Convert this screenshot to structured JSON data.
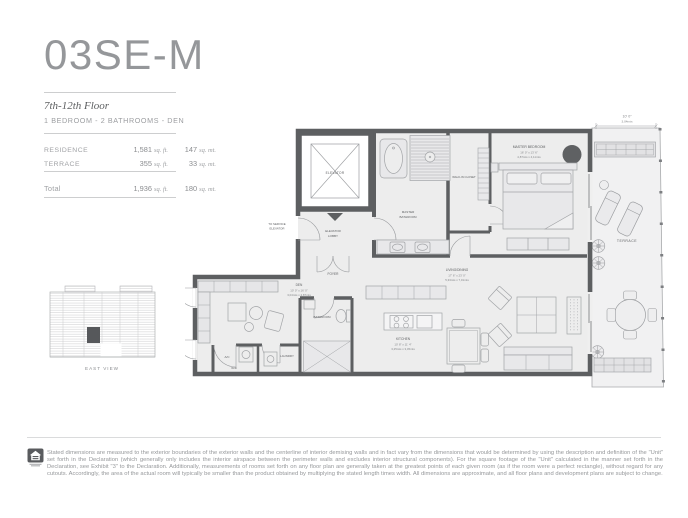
{
  "header": {
    "unit_name": "03SE-M",
    "floors": "7th-12th Floor",
    "program": "1 BEDROOM - 2 BATHROOMS - DEN"
  },
  "area_table": {
    "rows": [
      {
        "label": "RESIDENCE",
        "sqft": "1,581",
        "sqft_unit": "sq. ft.",
        "sqmt": "147",
        "sqmt_unit": "sq. mt."
      },
      {
        "label": "TERRACE",
        "sqft": "355",
        "sqft_unit": "sq. ft.",
        "sqmt": "33",
        "sqmt_unit": "sq. mt."
      }
    ],
    "total": {
      "label": "Total",
      "sqft": "1,936",
      "sqft_unit": "sq. ft.",
      "sqmt": "180",
      "sqmt_unit": "sq. mt."
    }
  },
  "keyplan": {
    "caption": "EAST VIEW"
  },
  "floorplan": {
    "elevator": "ELEVATOR",
    "service_1": "TO SERVICE",
    "service_2": "ELEVATOR",
    "lobby_1": "ELEVATOR",
    "lobby_2": "LOBBY",
    "foyer": "FOYER",
    "mbath_1": "MASTER",
    "mbath_2": "BATHROOM",
    "closet": "WALK-IN CLOSET",
    "mbed": "MASTER BEDROOM",
    "mbed_ft": "16' 0\" x 13' 6\"",
    "mbed_mt": "4,87mts x 4,11mts",
    "den": "DEN",
    "den_ft": "10' 0\" x 16' 0\"",
    "den_mt": "3,04mts x 4,87mts",
    "bath2": "BATHROOM",
    "ac": "A/C",
    "wd": "W/D",
    "laundry": "LAUNDRY",
    "kitchen": "KITCHEN",
    "kitchen_ft": "10' 8\" x 11' 4\"",
    "kitchen_mt": "3,25mts x 3,45mts",
    "living": "LIVING/DINING",
    "living_ft": "17' 6\" x 23' 0\"",
    "living_mt": "5,33mts x 7,01mts",
    "terrace": "TERRACE",
    "dim_ft": "10' 0\"",
    "dim_mt": "3,04mts"
  },
  "footer": {
    "disclaimer": "Stated dimensions are measured to the exterior boundaries of the exterior walls and the centerline of interior demising walls and in fact vary from the dimensions that would be determined by using the description and definition of the \"Unit\" set forth in the Declaration (which generally only includes the interior airspace between the perimeter walls and excludes interior structural components).  For the square footage of the \"Unit\" calculated in the manner set forth in the Declaration, see Exhibit \"3\" to the Declaration.  Additionally, measurements of rooms set forth on any floor plan are generally taken at the greatest points of each given room (as if the room were a perfect rectangle), without regard for any cutouts.  Accordingly, the area of the actual room will typically be smaller than the product obtained by multiplying the stated length times width. All dimensions are approximate, and all floor plans and development plans are subject to change.",
    "logo_name": "equal-housing-logo"
  },
  "colors": {
    "wall": "#5d5f61",
    "floor_fill": "#ededed",
    "terrace_fill": "#f1f1f2",
    "title_gray": "#95979a"
  }
}
